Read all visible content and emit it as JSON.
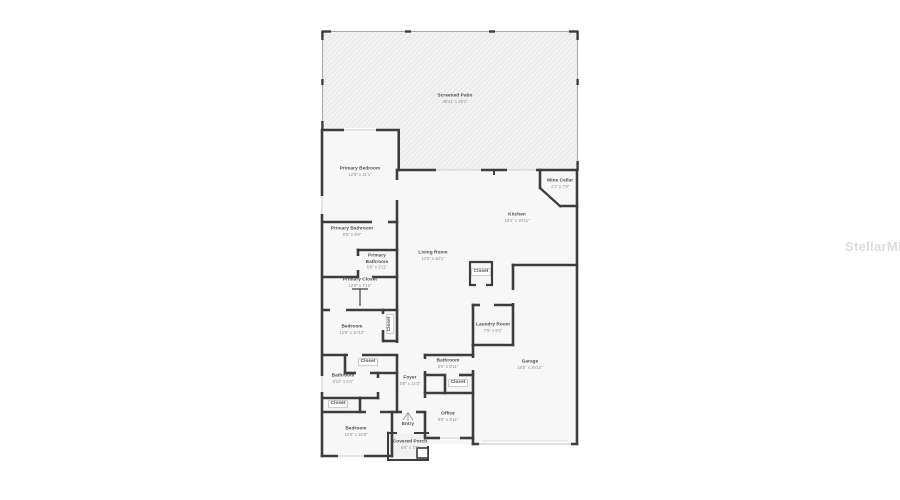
{
  "watermark": "StellarMLS",
  "plan": {
    "rooms": [
      {
        "label": "Screened Patio",
        "dims": "46'11\" x 25'1\""
      },
      {
        "label": "Primary Bedroom",
        "dims": "12'8\" x 21'1\""
      },
      {
        "label": "Primary Bathroom",
        "dims": "9'5\" x 9'9\""
      },
      {
        "label": "Primary Bathroom",
        "dims": "5'9\" x 2'11\""
      },
      {
        "label": "Primary Closet",
        "dims": "12'8\" x 7'10\""
      },
      {
        "label": "Closet",
        "dims": ""
      },
      {
        "label": "Bedroom",
        "dims": "12'8\" x 10'10\""
      },
      {
        "label": "Closet",
        "dims": ""
      },
      {
        "label": "Bathroom",
        "dims": "8'10\" x 8'4\""
      },
      {
        "label": "Closet",
        "dims": ""
      },
      {
        "label": "Bedroom",
        "dims": "12'8\" x 10'9\""
      },
      {
        "label": "Foyer",
        "dims": "5'8\" x 14'3\""
      },
      {
        "label": "Bathroom",
        "dims": "5'6\" x 8'11\""
      },
      {
        "label": "Closet",
        "dims": ""
      },
      {
        "label": "Office",
        "dims": "8'9\" x 9'11\""
      },
      {
        "label": "Entry",
        "dims": ""
      },
      {
        "label": "Covered Porch",
        "dims": "6'5\" x 7'5\""
      },
      {
        "label": "Living Room",
        "dims": "14'5\" x 40'1\""
      },
      {
        "label": "Closet",
        "dims": ""
      },
      {
        "label": "Laundry Room",
        "dims": "7'5\" x 9'4\""
      },
      {
        "label": "Garage",
        "dims": "18'5\" x 29'10\""
      },
      {
        "label": "Kitchen",
        "dims": "19'2\" x 20'11\""
      },
      {
        "label": "Wine Cellar",
        "dims": "4'1\" x 7'9\""
      }
    ]
  },
  "colors": {
    "wall": "#3d3d3d",
    "room_fill": "#f7f7f8",
    "patio_fill": "#f3f3f4",
    "watermark": "#dcdcdc"
  }
}
